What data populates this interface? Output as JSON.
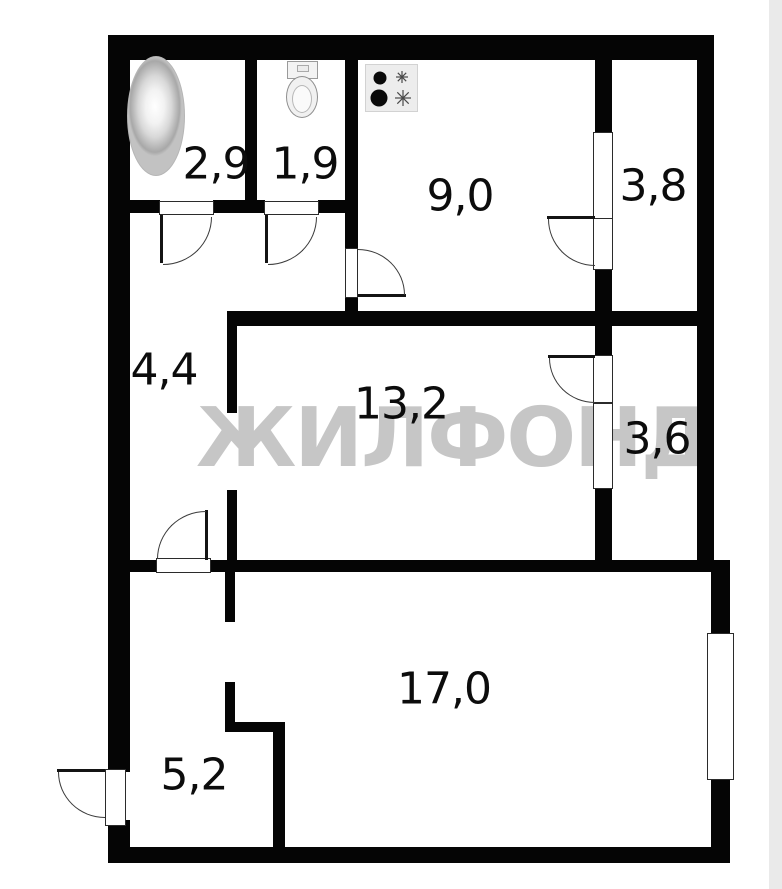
{
  "watermark": "ЖИЛФОНД",
  "rooms": {
    "bathroom": {
      "area": "2,9"
    },
    "toilet": {
      "area": "1,9"
    },
    "kitchen": {
      "area": "9,0"
    },
    "balcony_top": {
      "area": "3,8"
    },
    "hallway": {
      "area": "4,4"
    },
    "living_room": {
      "area": "13,2"
    },
    "balcony_middle": {
      "area": "3,6"
    },
    "main_room": {
      "area": "17,0"
    },
    "entry": {
      "area": "5,2"
    }
  },
  "fixtures": {
    "bathtub": "bathtub",
    "toilet": "toilet",
    "stove": "stove"
  },
  "colors": {
    "wall": "#050505",
    "watermark": "#c6c6c6",
    "background": "#ffffff",
    "edge_strip": "#eaeaea"
  }
}
